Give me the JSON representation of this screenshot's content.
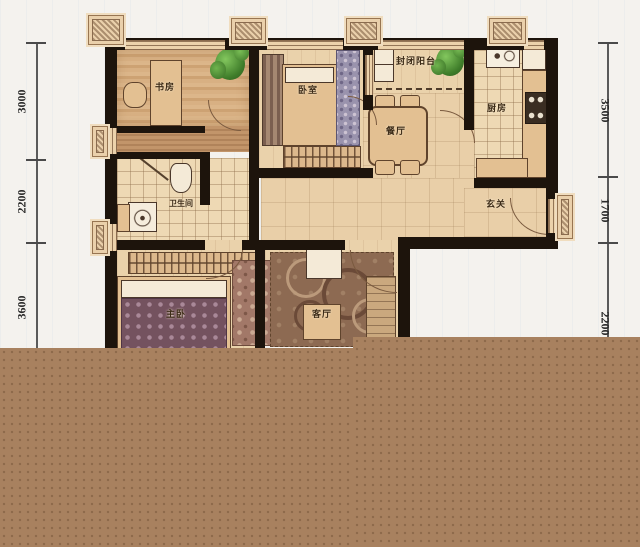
{
  "plan": {
    "type": "apartment-floor-plan",
    "rooms": {
      "study": {
        "label": "书房"
      },
      "bedroom": {
        "label": "卧室"
      },
      "balcony": {
        "label": "封闭阳台"
      },
      "kitchen": {
        "label": "厨房"
      },
      "dining": {
        "label": "餐厅"
      },
      "bathroom": {
        "label": "卫生间"
      },
      "entry": {
        "label": "玄关"
      },
      "master_bedroom": {
        "label": "主卧"
      },
      "living_room": {
        "label": "客厅"
      }
    },
    "dimensions": {
      "left": [
        {
          "value": "3000"
        },
        {
          "value": "2200"
        },
        {
          "value": "3600"
        }
      ],
      "right": [
        {
          "value": "3500"
        },
        {
          "value": "1700"
        },
        {
          "value": "2200"
        }
      ]
    },
    "colors": {
      "wall": "#1d140c",
      "floor_tan": "#e9cfa8",
      "wood": "#c89a6d",
      "tile": "#eed9b4",
      "plant_green": "#3f7d2a",
      "crop_overlay_brown": "#a8815f",
      "background": "#f4f2ee"
    }
  }
}
